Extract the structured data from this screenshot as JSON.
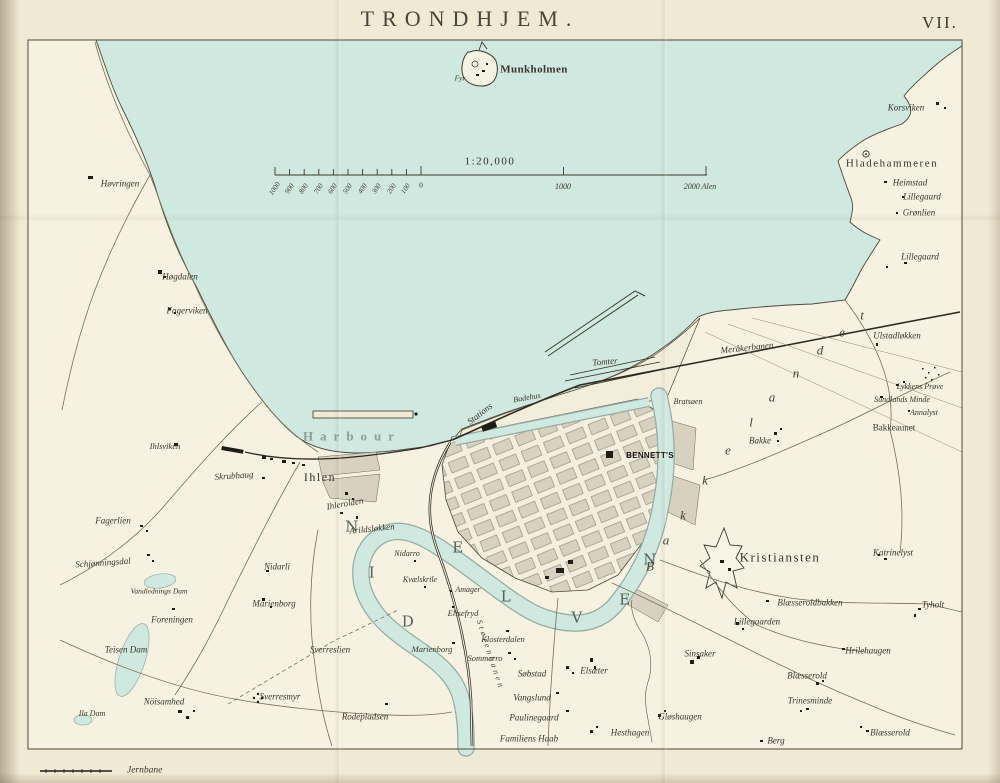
{
  "page": {
    "title": "TRONDHJEM.",
    "plate": "VII."
  },
  "legend": {
    "railway": "Jernbane"
  },
  "scale": {
    "ratio": "1:20,000",
    "minor_labels": [
      "1000",
      "900",
      "800",
      "700",
      "600",
      "500",
      "400",
      "300",
      "200",
      "100"
    ],
    "zero": "0",
    "major_labels": [
      "1000",
      "2000 Alen"
    ]
  },
  "colors": {
    "water": "#cfe8e0",
    "paper": "#f0e9d4",
    "land": "#f6f1e0",
    "block": "#d9d1c0",
    "ink": "#3a362b",
    "water_edge": "#95ada5"
  },
  "map_labels": [
    {
      "t": "Munkholmen",
      "x": 534,
      "y": 70,
      "s": 11,
      "c": "b"
    },
    {
      "t": "Fyr",
      "x": 460,
      "y": 78,
      "s": 7.5,
      "c": "i"
    },
    {
      "t": "1:20,000",
      "x": 490,
      "y": 162,
      "s": 11,
      "c": "r2"
    },
    {
      "t": "0",
      "x": 421,
      "y": 185,
      "s": 7.5,
      "c": "r"
    },
    {
      "t": "1000",
      "x": 563,
      "y": 187,
      "s": 8,
      "c": "i"
    },
    {
      "t": "2000 Alen",
      "x": 700,
      "y": 187,
      "s": 8,
      "c": "i"
    },
    {
      "t": "Korsviken",
      "x": 906,
      "y": 108,
      "c": "i"
    },
    {
      "t": "Hladehammeren",
      "x": 892,
      "y": 164,
      "s": 11,
      "c": "r2"
    },
    {
      "t": "Heimstad",
      "x": 910,
      "y": 183,
      "c": "i"
    },
    {
      "t": "Lillegaard",
      "x": 922,
      "y": 197,
      "c": "i"
    },
    {
      "t": "Grønlien",
      "x": 919,
      "y": 213,
      "c": "i"
    },
    {
      "t": "Lillegaard",
      "x": 920,
      "y": 257,
      "c": "i"
    },
    {
      "t": "Høvringen",
      "x": 120,
      "y": 184,
      "c": "i"
    },
    {
      "t": "Høgdalen",
      "x": 180,
      "y": 277,
      "c": "i"
    },
    {
      "t": "Fagerviken",
      "x": 187,
      "y": 311,
      "c": "i"
    },
    {
      "t": "Ihlsviken",
      "x": 165,
      "y": 446,
      "s": 8.5,
      "c": "i"
    },
    {
      "t": "Skrubhaug",
      "x": 234,
      "y": 476,
      "r": -4,
      "c": "i"
    },
    {
      "t": "Ihlen",
      "x": 320,
      "y": 477,
      "s": 12,
      "c": "r2"
    },
    {
      "t": "Harbour",
      "x": 352,
      "y": 436,
      "s": 13,
      "c": "sp"
    },
    {
      "t": "Ihlerolden",
      "x": 345,
      "y": 504,
      "r": -10,
      "c": "i"
    },
    {
      "t": "Arildsløkken",
      "x": 372,
      "y": 529,
      "r": -6,
      "c": "i"
    },
    {
      "t": "Fagerlien",
      "x": 113,
      "y": 521,
      "c": "i"
    },
    {
      "t": "Schjønningsdal",
      "x": 103,
      "y": 563,
      "r": -4,
      "c": "i"
    },
    {
      "t": "Vandlednings Dam",
      "x": 159,
      "y": 591,
      "s": 7.5,
      "c": "i"
    },
    {
      "t": "Nidarli",
      "x": 277,
      "y": 567,
      "c": "i"
    },
    {
      "t": "Marienborg",
      "x": 274,
      "y": 604,
      "c": "i"
    },
    {
      "t": "Foreningen",
      "x": 172,
      "y": 620,
      "c": "i"
    },
    {
      "t": "Teisen Dam",
      "x": 126,
      "y": 650,
      "c": "i"
    },
    {
      "t": "Nöisamhed",
      "x": 164,
      "y": 702,
      "c": "i"
    },
    {
      "t": "Ila Dam",
      "x": 92,
      "y": 714,
      "s": 8,
      "c": "i"
    },
    {
      "t": "Sverresmyr",
      "x": 280,
      "y": 697,
      "c": "i"
    },
    {
      "t": "Sverreslien",
      "x": 330,
      "y": 650,
      "c": "i"
    },
    {
      "t": "Rodepladsen",
      "x": 365,
      "y": 717,
      "c": "i"
    },
    {
      "t": "Marienborg",
      "x": 432,
      "y": 649,
      "s": 8.5,
      "c": "i"
    },
    {
      "t": "Sommerro",
      "x": 485,
      "y": 658,
      "s": 8.5,
      "c": "i"
    },
    {
      "t": "Klosterdalen",
      "x": 503,
      "y": 639,
      "s": 8.5,
      "c": "i"
    },
    {
      "t": "Elisefryd",
      "x": 463,
      "y": 613,
      "s": 8.5,
      "c": "i"
    },
    {
      "t": "Amager",
      "x": 468,
      "y": 590,
      "s": 8,
      "c": "i"
    },
    {
      "t": "Kvælskrile",
      "x": 420,
      "y": 580,
      "s": 8,
      "c": "i"
    },
    {
      "t": "Nidarro",
      "x": 407,
      "y": 554,
      "s": 8,
      "c": "i"
    },
    {
      "t": "Søbstad",
      "x": 532,
      "y": 674,
      "c": "i"
    },
    {
      "t": "Elsæter",
      "x": 594,
      "y": 671,
      "c": "i"
    },
    {
      "t": "Vangslund",
      "x": 532,
      "y": 698,
      "c": "i"
    },
    {
      "t": "Paulinegaard",
      "x": 534,
      "y": 718,
      "c": "i"
    },
    {
      "t": "Familiens Haab",
      "x": 529,
      "y": 739,
      "c": "i"
    },
    {
      "t": "Hesthagen",
      "x": 630,
      "y": 733,
      "c": "i"
    },
    {
      "t": "Gløshaugen",
      "x": 680,
      "y": 717,
      "c": "i"
    },
    {
      "t": "Sinsaker",
      "x": 700,
      "y": 654,
      "c": "i"
    },
    {
      "t": "Kristiansten",
      "x": 780,
      "y": 557,
      "s": 13,
      "c": "r2"
    },
    {
      "t": "Katrinelyst",
      "x": 893,
      "y": 553,
      "c": "i"
    },
    {
      "t": "Blæsseroldbakken",
      "x": 810,
      "y": 603,
      "c": "i"
    },
    {
      "t": "Lillegaarden",
      "x": 757,
      "y": 622,
      "c": "i"
    },
    {
      "t": "Tyholt",
      "x": 933,
      "y": 605,
      "c": "i"
    },
    {
      "t": "Hrilehaugen",
      "x": 868,
      "y": 651,
      "c": "i"
    },
    {
      "t": "Blæsserold",
      "x": 807,
      "y": 676,
      "c": "i"
    },
    {
      "t": "Trinesminde",
      "x": 810,
      "y": 701,
      "c": "i"
    },
    {
      "t": "Blæsserold",
      "x": 890,
      "y": 733,
      "c": "i"
    },
    {
      "t": "Berg",
      "x": 776,
      "y": 741,
      "c": "i"
    },
    {
      "t": "Bakke",
      "x": 760,
      "y": 441,
      "c": "i"
    },
    {
      "t": "Bakkeaunet",
      "x": 894,
      "y": 428,
      "s": 9,
      "c": "r"
    },
    {
      "t": "Annalyst",
      "x": 924,
      "y": 413,
      "s": 8,
      "c": "i"
    },
    {
      "t": "Sundlands Minde",
      "x": 902,
      "y": 400,
      "s": 8,
      "c": "i"
    },
    {
      "t": "Lykkens Prøve",
      "x": 920,
      "y": 387,
      "s": 8,
      "c": "i"
    },
    {
      "t": "Ulstadløkken",
      "x": 897,
      "y": 336,
      "c": "i"
    },
    {
      "t": "Meråkerbanen",
      "x": 747,
      "y": 348,
      "r": -6,
      "c": "i"
    },
    {
      "t": "Tomter",
      "x": 605,
      "y": 362,
      "r": -5,
      "c": "i"
    },
    {
      "t": "Bratsøen",
      "x": 688,
      "y": 402,
      "s": 8,
      "c": "i"
    },
    {
      "t": "Stations",
      "x": 480,
      "y": 414,
      "r": -38,
      "c": "i"
    },
    {
      "t": "Badehus",
      "x": 527,
      "y": 398,
      "s": 8,
      "r": -10,
      "c": "i"
    },
    {
      "t": "BENNETT'S",
      "x": 650,
      "y": 456,
      "s": 8,
      "c": "ben"
    },
    {
      "t": "Størenbanen",
      "x": 490,
      "y": 655,
      "s": 8,
      "r": 72,
      "c": "spr"
    },
    {
      "t": "N",
      "x": 352,
      "y": 527,
      "s": 15,
      "c": "riv"
    },
    {
      "t": "I",
      "x": 372,
      "y": 573,
      "s": 15,
      "c": "riv"
    },
    {
      "t": "D",
      "x": 408,
      "y": 622,
      "s": 15,
      "c": "riv"
    },
    {
      "t": "E",
      "x": 458,
      "y": 548,
      "s": 15,
      "c": "riv"
    },
    {
      "t": "L",
      "x": 506,
      "y": 597,
      "s": 15,
      "c": "riv"
    },
    {
      "t": "V",
      "x": 577,
      "y": 618,
      "s": 15,
      "c": "riv"
    },
    {
      "t": "E",
      "x": 625,
      "y": 600,
      "s": 15,
      "c": "riv"
    },
    {
      "t": "N",
      "x": 650,
      "y": 560,
      "s": 15,
      "c": "riv"
    },
    {
      "t": "B",
      "x": 650,
      "y": 566,
      "s": 13,
      "c": "dis"
    },
    {
      "t": "a",
      "x": 666,
      "y": 540,
      "s": 13,
      "c": "dis"
    },
    {
      "t": "k",
      "x": 683,
      "y": 515,
      "s": 13,
      "c": "dis"
    },
    {
      "t": "k",
      "x": 705,
      "y": 480,
      "s": 13,
      "c": "dis"
    },
    {
      "t": "e",
      "x": 728,
      "y": 450,
      "s": 13,
      "c": "dis"
    },
    {
      "t": "l",
      "x": 751,
      "y": 422,
      "s": 13,
      "c": "dis"
    },
    {
      "t": "a",
      "x": 772,
      "y": 397,
      "s": 13,
      "c": "dis"
    },
    {
      "t": "n",
      "x": 796,
      "y": 373,
      "s": 13,
      "c": "dis"
    },
    {
      "t": "d",
      "x": 820,
      "y": 350,
      "s": 13,
      "c": "dis"
    },
    {
      "t": "e",
      "x": 842,
      "y": 332,
      "s": 13,
      "c": "dis"
    },
    {
      "t": "t",
      "x": 862,
      "y": 315,
      "s": 13,
      "c": "dis"
    }
  ]
}
